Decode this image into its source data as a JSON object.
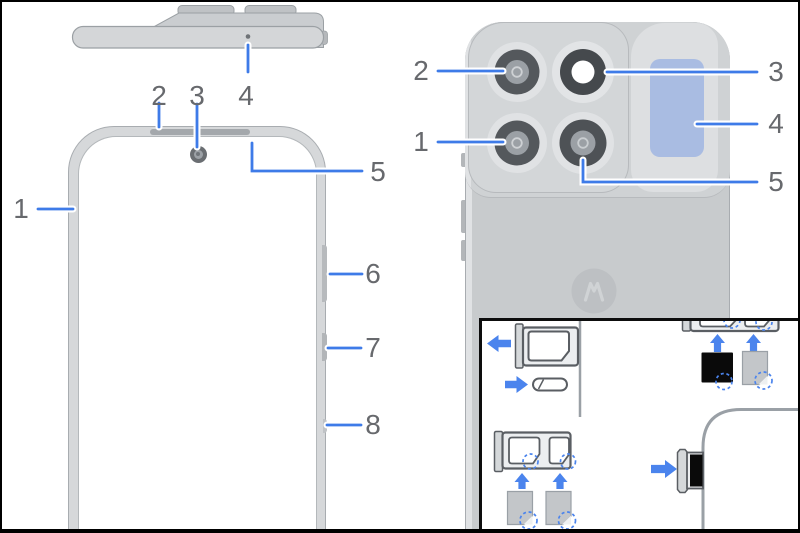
{
  "figure": {
    "kind": "phone-hardware-diagram",
    "brand_logo": "motorola"
  },
  "front_view": {
    "name": "front-and-top-edge-view",
    "callouts": [
      "1",
      "2",
      "3",
      "4",
      "5",
      "6",
      "7",
      "8"
    ]
  },
  "back_view": {
    "name": "rear-camera-view",
    "callouts": [
      "1",
      "2",
      "3",
      "4",
      "5"
    ]
  },
  "sim_inset": {
    "name": "sim-tray-instructions",
    "elements": [
      "eject-tray",
      "eject-tool",
      "dual-sim-tray",
      "sim-cards",
      "microsd-card",
      "insert-tray"
    ]
  },
  "colors": {
    "callout_line": "#3e7be8",
    "arrow_blue": "#4b84ed",
    "label_gray": "#67696d",
    "flash_panel_blue": "#a9bce2",
    "phone_gray": "#c8cbcd"
  }
}
